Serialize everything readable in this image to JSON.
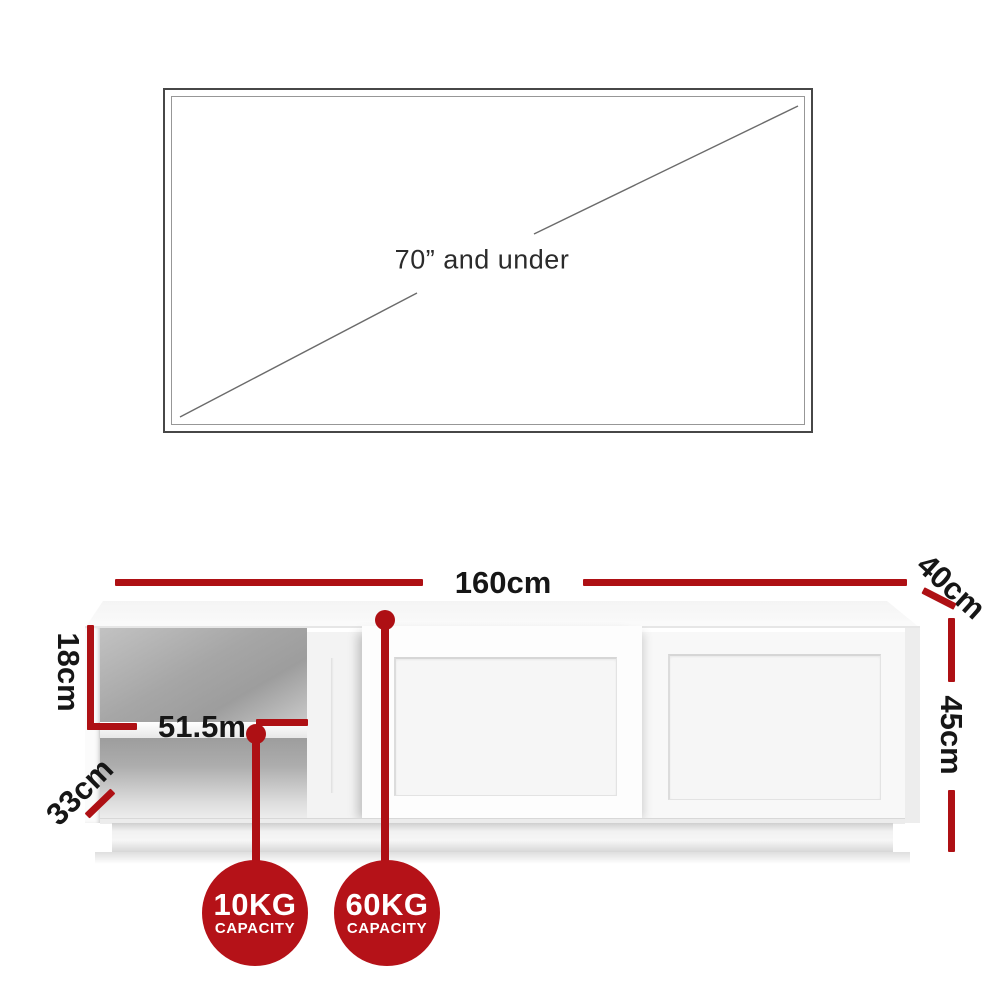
{
  "tv": {
    "size_label": "70” and under"
  },
  "dimensions": {
    "width": "160cm",
    "depth": "40cm",
    "height": "45cm",
    "compartment_height": "18cm",
    "compartment_width": "51.5m",
    "compartment_depth": "33cm"
  },
  "badges": [
    {
      "weight": "10KG",
      "label": "CAPACITY"
    },
    {
      "weight": "60KG",
      "label": "CAPACITY"
    }
  ],
  "colors": {
    "dimension_red": "#ae1014",
    "badge_red": "#b51218",
    "text_black": "#161616"
  }
}
